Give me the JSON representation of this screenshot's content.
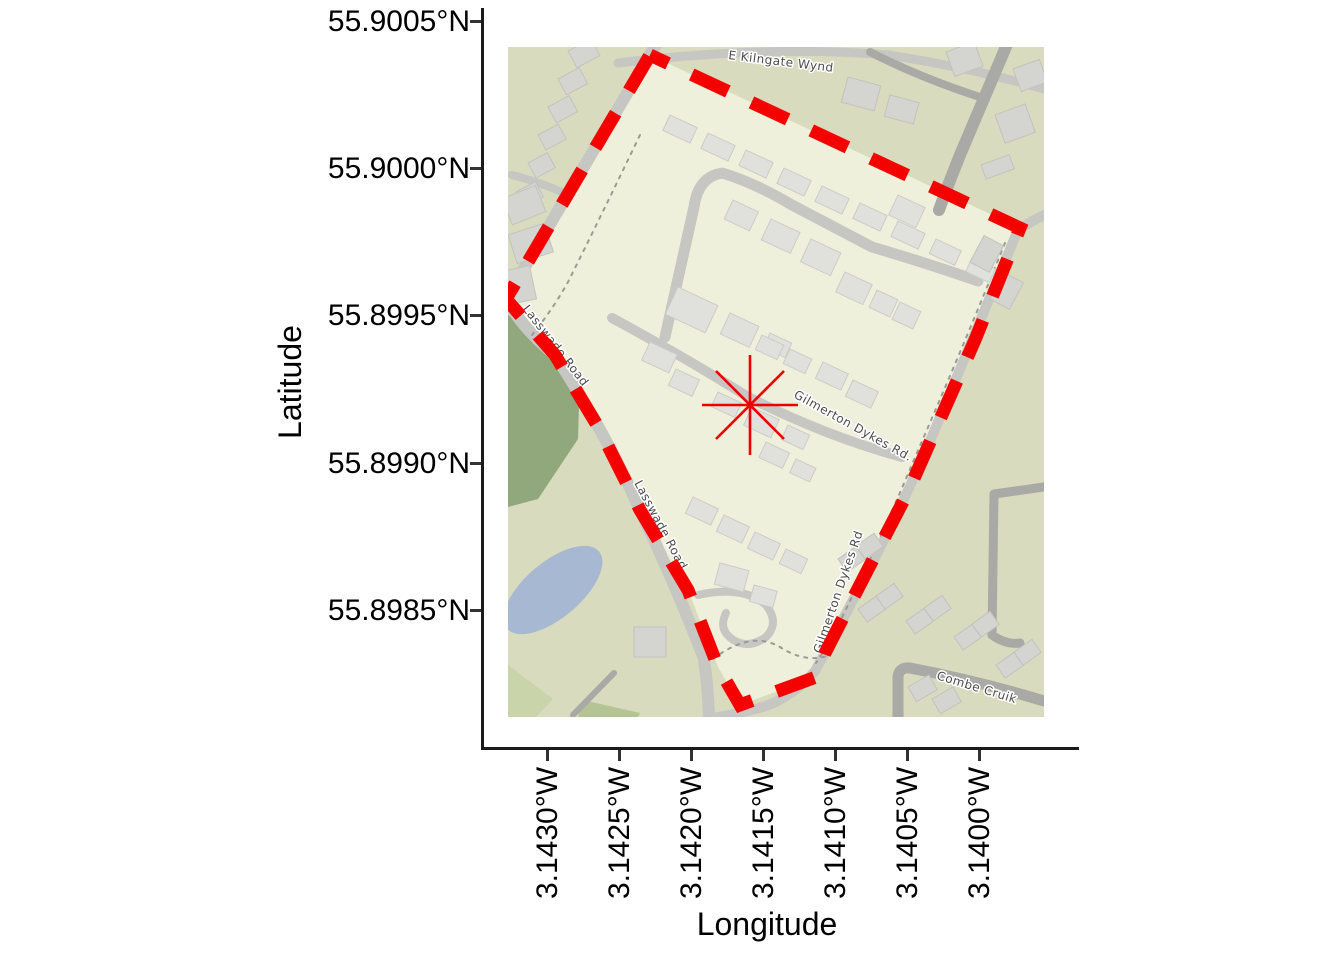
{
  "figure": {
    "axes": {
      "y": {
        "title": "Latitude",
        "ticks": [
          "55.9005°N",
          "55.9000°N",
          "55.8995°N",
          "55.8990°N",
          "55.8985°N"
        ]
      },
      "x": {
        "title": "Longitude",
        "ticks": [
          "3.1430°W",
          "3.1425°W",
          "3.1420°W",
          "3.1415°W",
          "3.1410°W",
          "3.1405°W",
          "3.1400°W"
        ]
      }
    }
  },
  "map": {
    "street_labels": {
      "kilngate": "E Kilngate Wynd",
      "lasswade_upper": "Lasswade Road",
      "lasswade_lower": "Lasswade Road",
      "gilmerton_center": "Gilmerton Dykes Rd.",
      "gilmerton_right": "Gilmerton Dykes Rd",
      "combe_cruik": "Combe Cruik"
    },
    "colors": {
      "background": "#d8dbbd",
      "estate": "#eff0db",
      "park": "#91a87c",
      "water": "#a6b8d2",
      "road": "#c6c6c3",
      "road_dark": "#a9a9a6",
      "building": "#e0e1dc",
      "building_outside": "#d4d5d1",
      "boundary": "#f50100",
      "marker": "#ee0000",
      "street_label_text": "#4c4c4c"
    },
    "marker": {
      "type": "asterisk",
      "approx_position": {
        "lat": "55.8992°N",
        "lon": "3.1416°W"
      }
    },
    "boundary": {
      "style": "red dashed polygon"
    }
  },
  "chart_data": {
    "type": "map",
    "xlabel": "Longitude",
    "ylabel": "Latitude",
    "x_ticks": [
      "3.1430°W",
      "3.1425°W",
      "3.1420°W",
      "3.1415°W",
      "3.1410°W",
      "3.1405°W",
      "3.1400°W"
    ],
    "y_ticks": [
      "55.9005°N",
      "55.9000°N",
      "55.8995°N",
      "55.8990°N",
      "55.8985°N"
    ],
    "x_range_approx_deg_W": [
      3.1435,
      3.1393
    ],
    "y_range_approx_deg_N": [
      55.898,
      55.9006
    ],
    "marker_point": {
      "lat_deg_N": 55.8992,
      "lon_deg_W": 3.1416
    },
    "boundary_polygon_approx": [
      {
        "lat_deg_N": 55.9004,
        "lon_deg_W": 3.1423
      },
      {
        "lat_deg_N": 55.8998,
        "lon_deg_W": 3.1397
      },
      {
        "lat_deg_N": 55.8982,
        "lon_deg_W": 3.1417
      },
      {
        "lat_deg_N": 55.8996,
        "lon_deg_W": 3.1433
      }
    ],
    "streets": [
      "E Kilngate Wynd",
      "Lasswade Road",
      "Gilmerton Dykes Rd",
      "Combe Cruik"
    ]
  }
}
